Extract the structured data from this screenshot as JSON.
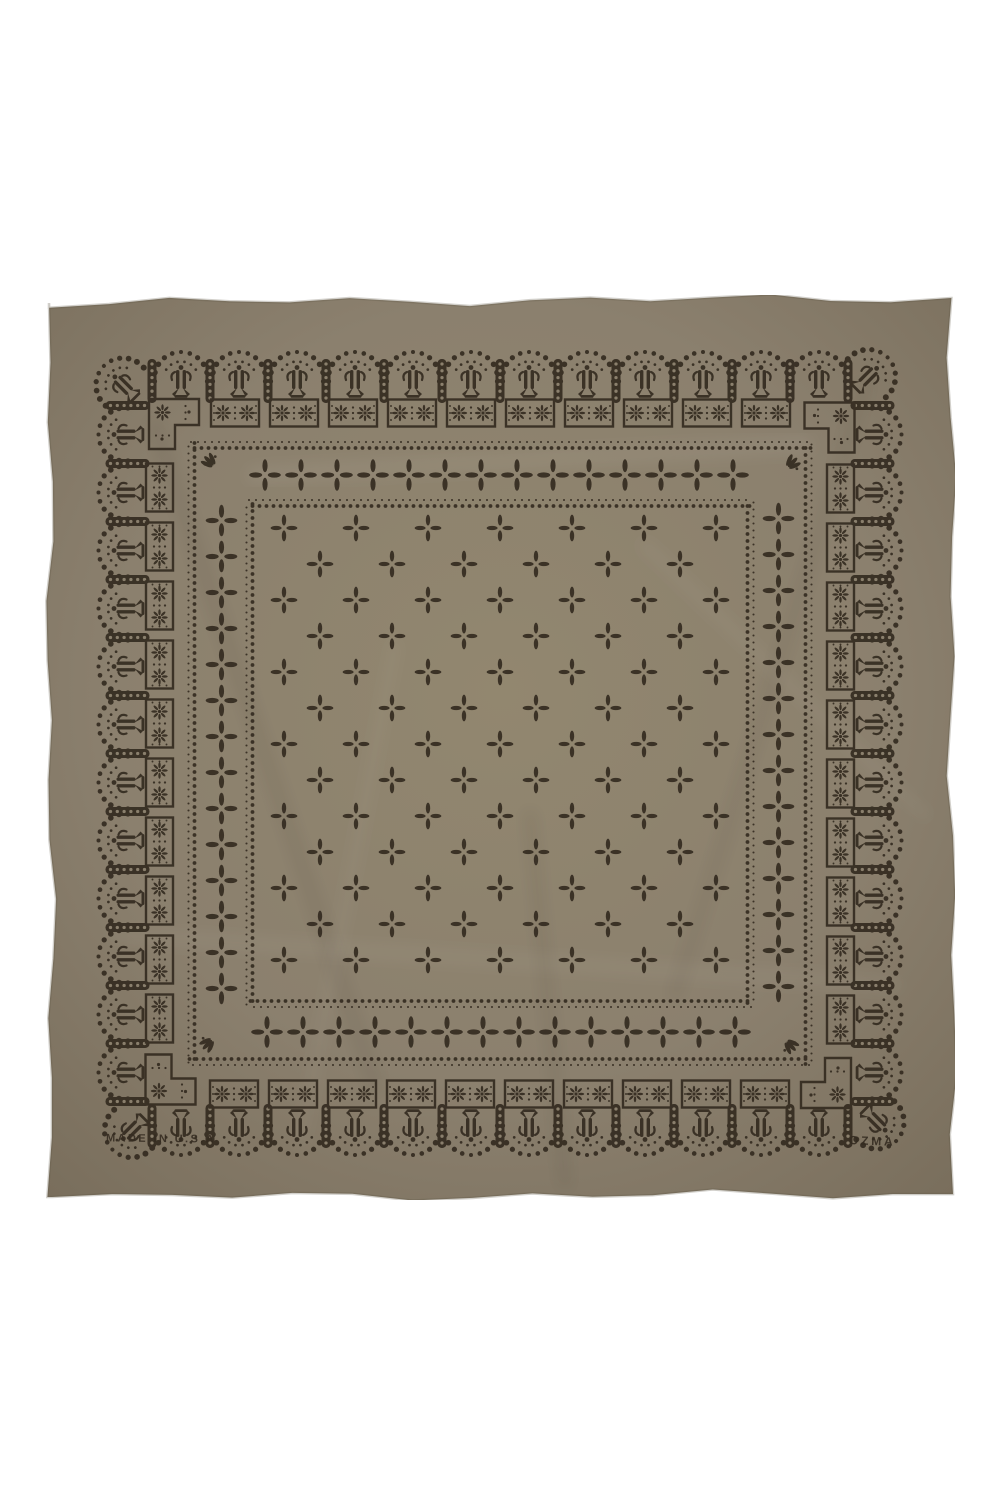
{
  "page": {
    "background_color": "#ffffff"
  },
  "bandana": {
    "description": "square olive-taupe silk bandana, flat lay, dark geometric block print with arch border, rosette blocks, dotted frames and cross motifs",
    "fabric_color": "#8b806e",
    "fabric_highlight": "#92876f",
    "fabric_shadow": "#776c5a",
    "hem_color": "#5f5646",
    "print_color": "#342b20",
    "made_in_text": "MADE IN U.S.A",
    "brand_text": "OZMA"
  }
}
